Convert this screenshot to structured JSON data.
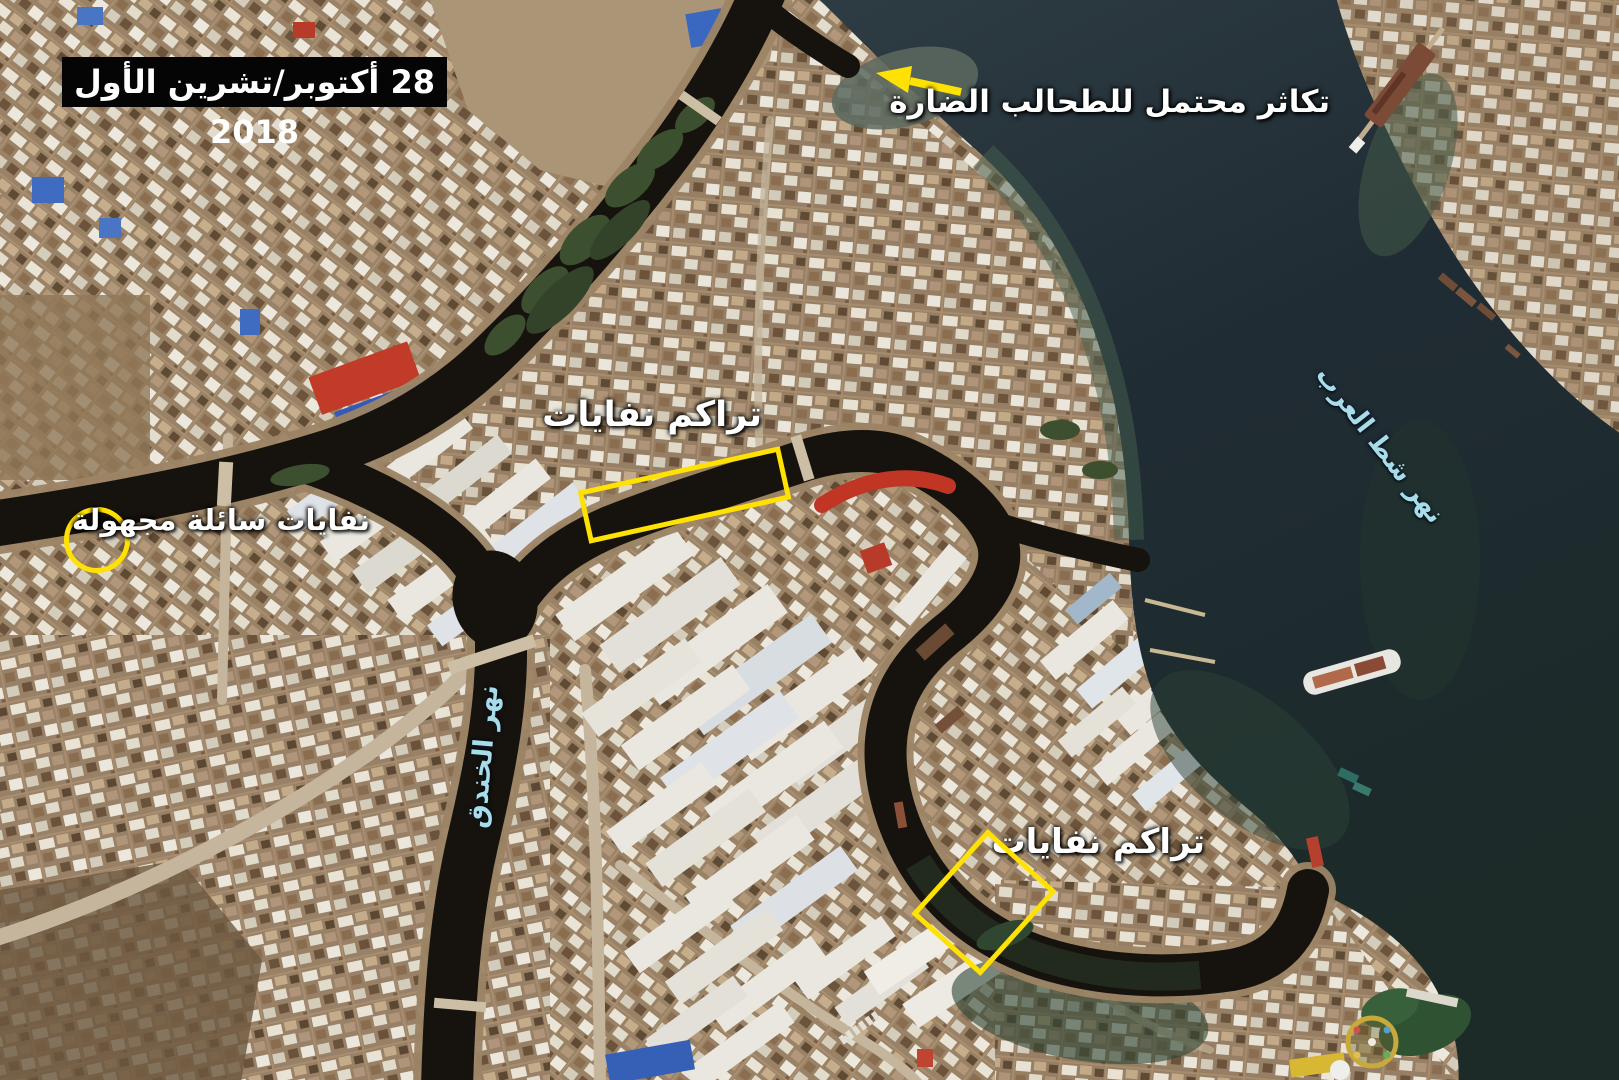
{
  "annotations": {
    "date_box": {
      "text": "28  أكتوبر/تشرين الأول 2018"
    },
    "algae_bloom": {
      "text": "تكاثر محتمل للطحالب الضارة",
      "marker": "arrow"
    },
    "waste_canal": {
      "text": "تراكم نفايات",
      "marker": "rectangle"
    },
    "waste_shipyard": {
      "text": "تراكم نفايات",
      "marker": "rectangle"
    },
    "liquid_waste": {
      "text": "نفايات سائلة مجهولة",
      "marker": "circle"
    },
    "shatt_al_arab": {
      "text": "نهر شط العرب"
    },
    "khandaq_canal": {
      "text": "نهر الخندق"
    }
  },
  "colors": {
    "highlight_yellow": "#ffe203",
    "river_label_cyan": "#a8dce8",
    "annotation_white": "#ffffff",
    "date_background": "#000000"
  }
}
